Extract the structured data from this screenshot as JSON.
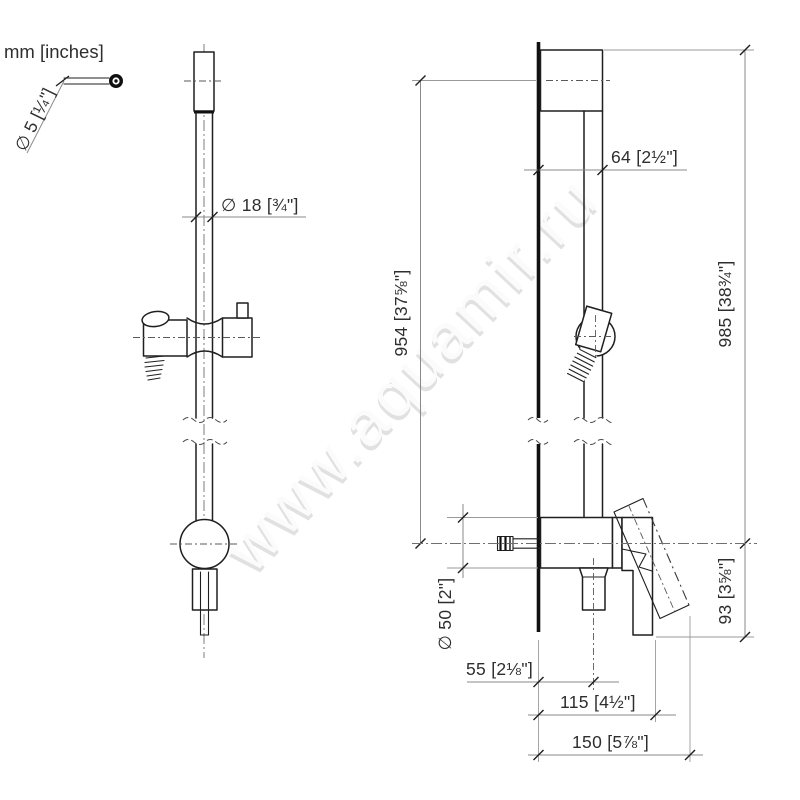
{
  "meta": {
    "units_note": "mm [inches]",
    "watermark": "www.aquamir.ru"
  },
  "dimensions": {
    "screw_diameter": "∅ 5 [¼\"]",
    "rail_diameter": "∅ 18 [¾\"]",
    "holder_offset": "64 [2½\"]",
    "bar_height": "954 [37⅝\"]",
    "overall_height": "985 [38¾\"]",
    "rosette_diameter": "∅ 50 [2\"]",
    "outlet_offset": "55 [2⅛\"]",
    "handle_projection": "115 [4½\"]",
    "max_projection": "150 [5⅞\"]",
    "handle_drop": "93 [3⅝\"]"
  },
  "colors": {
    "object_line": "#1f1f1f",
    "dimension_line": "#8a8a8a",
    "label_text": "#2e2e2e",
    "watermark_shadow": "#e1e1e1",
    "watermark_fill": "#fbfbfb",
    "background": "#ffffff"
  }
}
